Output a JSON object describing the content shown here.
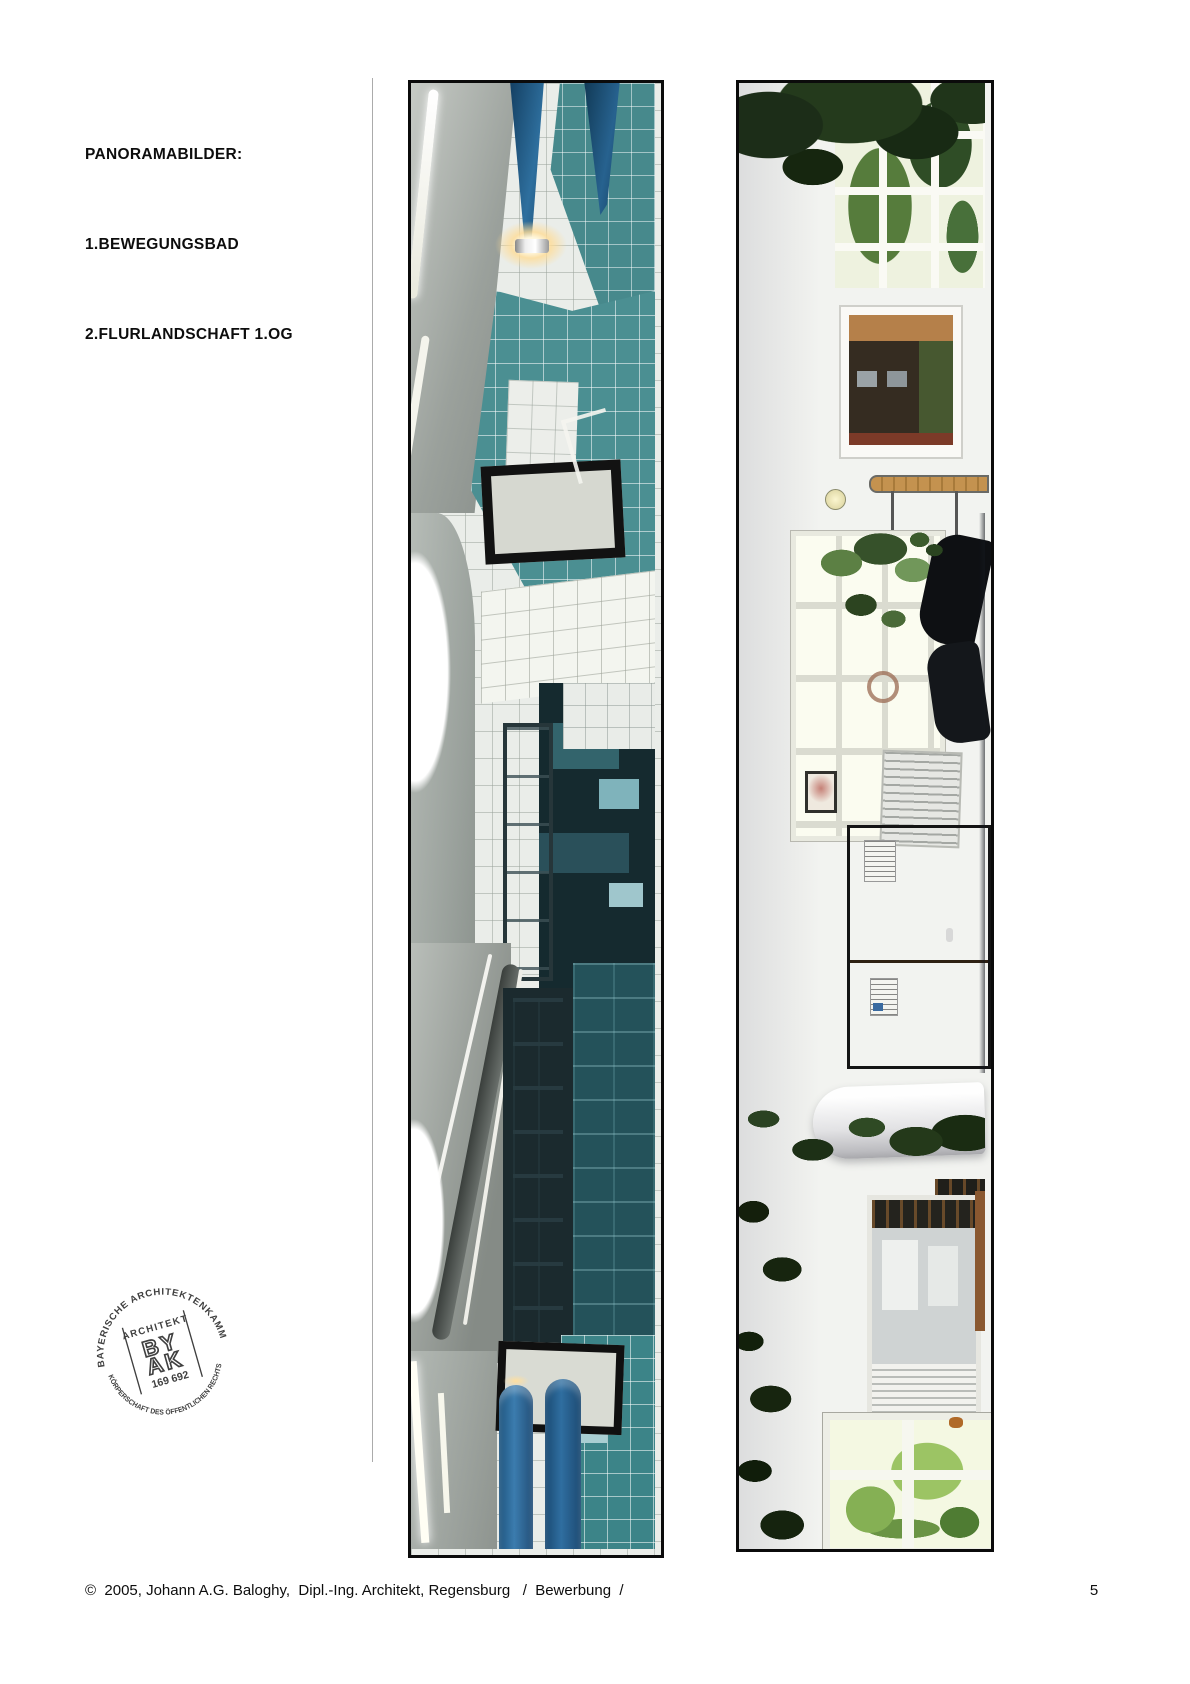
{
  "header": {
    "title": "PANORAMABILDER:",
    "caption_1": "1.BEWEGUNGSBAD",
    "caption_2": "2.FLURLANDSCHAFT 1.OG"
  },
  "stamp": {
    "arc_top": "BAYERISCHE ARCHITEKTENKAMMER",
    "arc_bottom": "KÖRPERSCHAFT DES ÖFFENTLICHEN RECHTS",
    "role_label": "ARCHITEKT",
    "logo_line_1": "BY",
    "logo_line_2": "AK",
    "member_number": "169 692"
  },
  "footer": {
    "copyright": "©  2005, Johann A.G. Baloghy,  Dipl.-Ing. Architekt, Regensburg   /  Bewerbung  /",
    "page_number": "5"
  },
  "colors": {
    "pool_teal": "#3f8a8e",
    "pool_teal_dark": "#24525a",
    "kayak_blue": "#2e6f9e",
    "wood_tan": "#c08b52",
    "foliage_green": "#23381c",
    "frame_black": "#0b0b0b"
  }
}
